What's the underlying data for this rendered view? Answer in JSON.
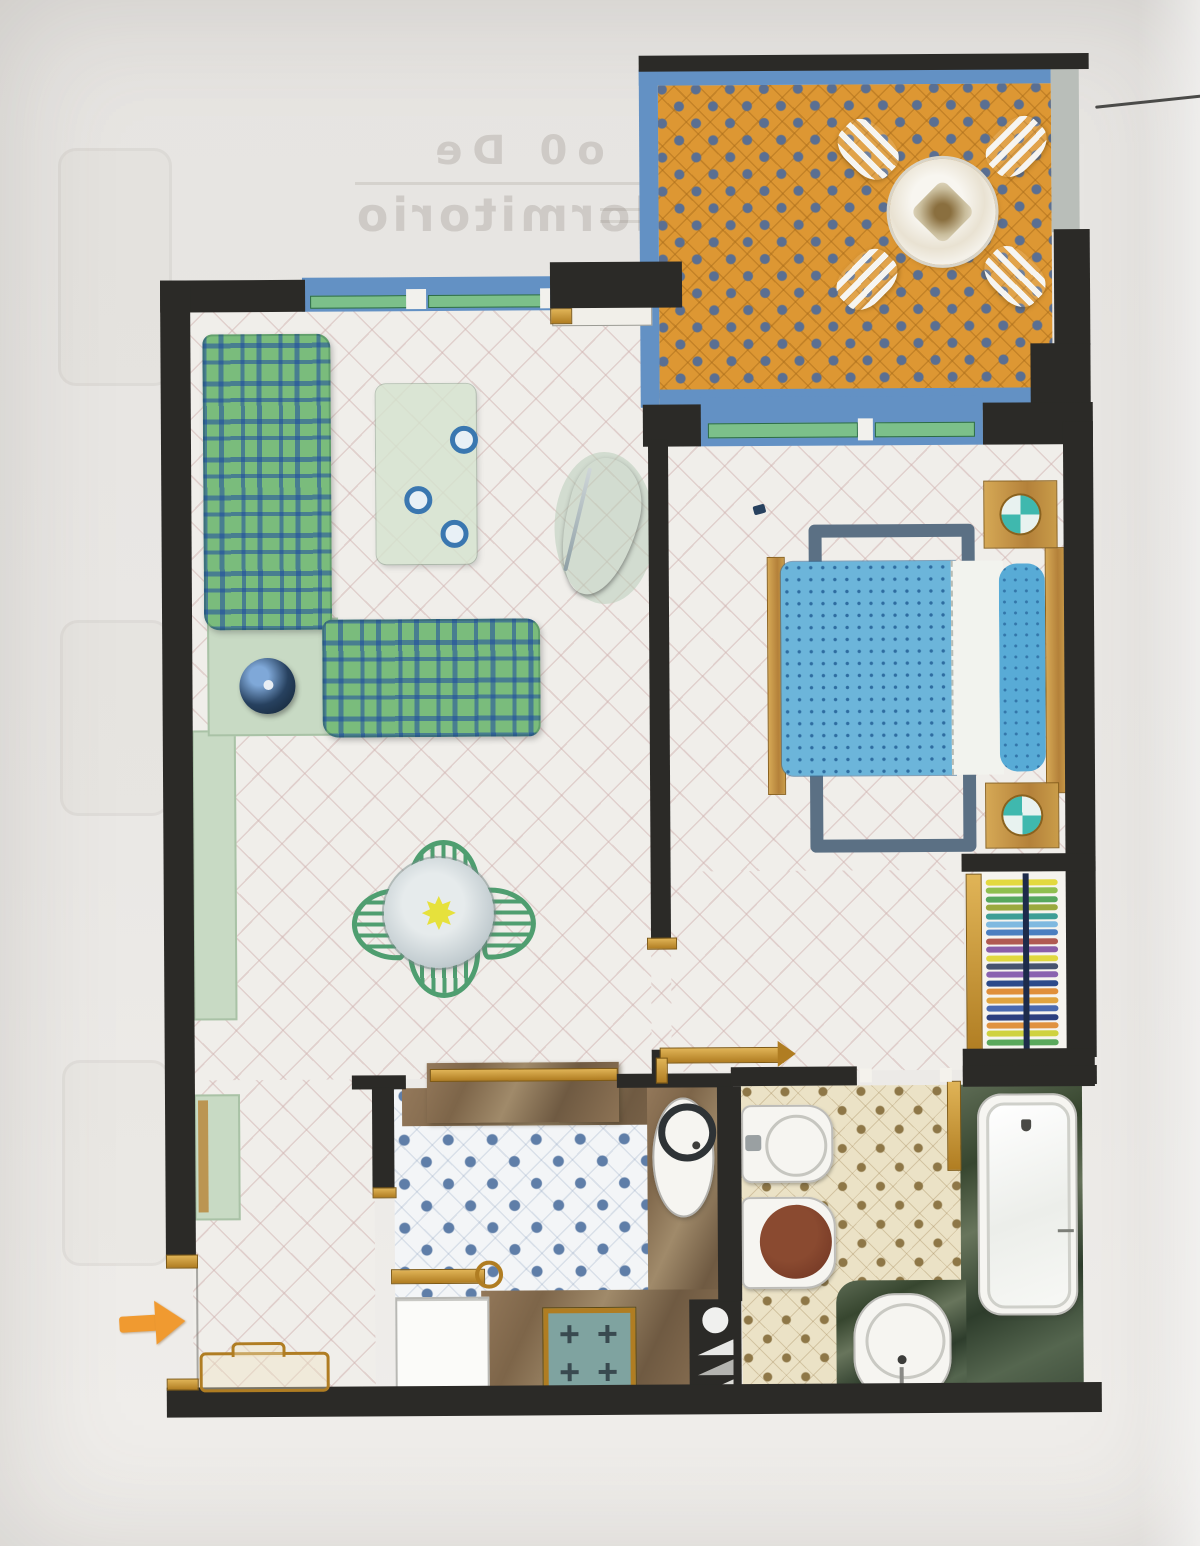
{
  "bleed_text": {
    "line1": "o0 De",
    "line2": "dormitorio"
  },
  "entry": {
    "arrow_icon": "entry-arrow",
    "direction": "right"
  },
  "colors": {
    "wall": "#2b2a27",
    "gold": "#c08a2c",
    "woodTan": "#c59a4a",
    "arrowOrange": "#f09a30",
    "tileBase": "#f0eeea",
    "terraceOrange": "#dd9733",
    "terraceDot": "#5a6f92",
    "terraceBlue": "#6391c4",
    "grayStrip": "#b9beb9",
    "kitchenBase": "#f3f5f7",
    "kitchenDot": "#5f7ea8",
    "bathBase": "#ebe2c6",
    "bathDot": "#8e7747",
    "paleGreen": "#c8dac4",
    "plaidGreen": "#7abc7c",
    "plaidBlue": "#2a56a4",
    "bedBlue": "#6cb5da",
    "bedDot": "#2f6f9f",
    "pillowBlue": "#58abd6",
    "sheetWhite": "#f2f3ee",
    "slate": "#5b7084",
    "chairGreen": "#4f9e70",
    "glassTable": "#c2ccd0",
    "sunYellow": "#e6e13c",
    "fixtureWhite": "#f6f5f1",
    "lampNavy": "#27415f",
    "stoveTeal": "#7fa3a0",
    "lidBrown": "#7a3d28"
  },
  "wardrobe": {
    "stripes": [
      "#e3d93f",
      "#8fbf4f",
      "#57a75e",
      "#9aa93e",
      "#3e9e96",
      "#7fb9e0",
      "#4b7fc0",
      "#b05a52",
      "#8a5ea8",
      "#e0d83f",
      "#47536e",
      "#8a62b0",
      "#2c4a8a",
      "#e08f3a",
      "#e0a43f",
      "#4a6ab0",
      "#2c3f7e",
      "#e0923f",
      "#cfd23f",
      "#5aa85c"
    ]
  },
  "rooms": {
    "terrace": {
      "floor": "orange-tile-blue-dots",
      "furniture": [
        "round-table",
        "slatted-chair-nw",
        "slatted-chair-ne",
        "slatted-chair-sw",
        "slatted-chair-se"
      ]
    },
    "living_room": {
      "floor": "white-diagonal-tile",
      "furniture": [
        "plaid-sofa-vertical",
        "plaid-sofa-horizontal",
        "corner-table",
        "sphere-lamp",
        "coffee-table",
        "tv-unit",
        "sideboard",
        "dining-table",
        "dining-chairs-x4"
      ]
    },
    "bedroom": {
      "floor": "white-diagonal-tile",
      "furniture": [
        "double-bed",
        "pillow",
        "foot-bench",
        "nightstand-top",
        "nightstand-bottom"
      ]
    },
    "wardrobe": {
      "furniture": [
        "closet-rail-with-clothes"
      ]
    },
    "bathroom": {
      "floor": "cream-tile-brown-dots",
      "furniture": [
        "bidet",
        "toilet",
        "washbasin",
        "bathtub",
        "towel-rail"
      ]
    },
    "kitchen": {
      "floor": "white-tile-blue-dots",
      "furniture": [
        "counter-top",
        "counter-right",
        "counter-bottom",
        "sink",
        "stove",
        "refrigerator",
        "service-shaft"
      ]
    },
    "hall": {
      "floor": "white-diagonal-tile",
      "furniture": [
        "console-table",
        "shoe-cabinet",
        "entry-arrow"
      ]
    }
  }
}
